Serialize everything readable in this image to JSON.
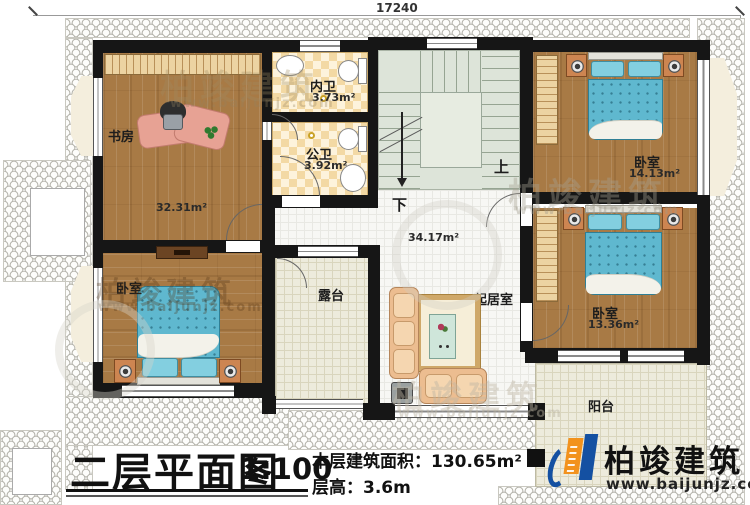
{
  "dimensions": {
    "top_width": "17240",
    "right_height": "10540"
  },
  "rooms": {
    "study": {
      "name": "书房",
      "area": "32.31m²"
    },
    "inner_bath": {
      "name": "内卫",
      "area": "3.73m²"
    },
    "public_bath": {
      "name": "公卫",
      "area": "3.92m²"
    },
    "hall": {
      "area": "34.17m²"
    },
    "bedroom_top_right": {
      "name": "卧室",
      "area": "14.13m²"
    },
    "bedroom_right": {
      "name": "卧室",
      "area": "13.36m²"
    },
    "bedroom_left": {
      "name": "卧室"
    },
    "terrace": {
      "name": "露台"
    },
    "living_room": {
      "name": "起居室"
    },
    "balcony": {
      "name": "阳台"
    }
  },
  "stairs": {
    "up_label": "上",
    "down_label": "下"
  },
  "title_block": {
    "title": "二层平面图",
    "scale": "1:100",
    "floor_area": "本层建筑面积：130.65m²",
    "floor_height": "层高：3.6m"
  },
  "branding": {
    "company": "柏竣建筑",
    "website": "www.baijunjz.com"
  },
  "watermark": {
    "text": "柏竣建筑",
    "url": "www.baijunjz.com"
  },
  "colors": {
    "wall": "#161616",
    "wood_floor": "#a87a45",
    "bed_blue": "#5fb8cf",
    "checker_tan": "#f3d9a4",
    "stair_green": "#dde4d9",
    "terrace_beige": "#edebdc",
    "logo_blue": "#1450a2",
    "logo_orange": "#f2921d"
  }
}
